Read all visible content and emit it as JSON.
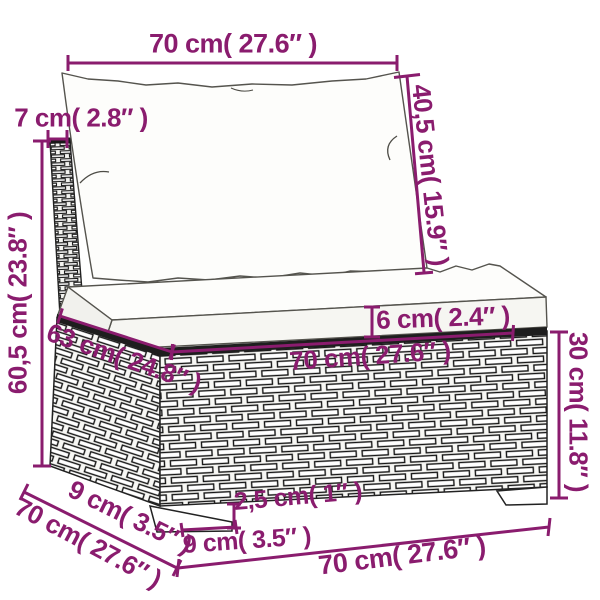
{
  "accent_color": "#8a1c6e",
  "dims": {
    "back_cushion_width": "70 cm( 27.6″ )",
    "back_cushion_height": "40,5 cm( 15.9″ )",
    "backrest_thickness": "7 cm( 2.8″ )",
    "backrest_height": "60,5 cm( 23.8″ )",
    "cushion_thickness": "6 cm( 2.4″ )",
    "seat_inner_depth": "63 cm( 24.8″ )",
    "seat_top_width": "70 cm( 27.6″ )",
    "base_height": "30 cm( 11.8″ )",
    "foot_inset_depth": "9 cm( 3.5″ )",
    "total_depth": "70 cm( 27.6″ )",
    "foot_width": "9 cm( 3.5″ )",
    "foot_height": "2,5 cm( 1″ )",
    "total_width": "70 cm( 27.6″ )"
  }
}
